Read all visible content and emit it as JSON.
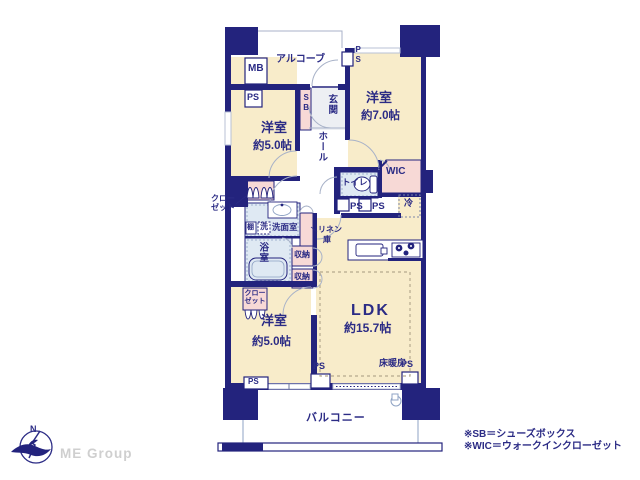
{
  "colors": {
    "wall_navy": "#23237d",
    "text_navy": "#2b2b85",
    "room_cream": "#f8ecca",
    "closet_pink": "#f7d9d6",
    "wet_blue": "#dfe9f3",
    "tile_gray": "#edeff3",
    "line_gray": "#a8b2c8",
    "heating_dash": "#b5a98e",
    "logo_gray": "#cfcfcf"
  },
  "rooms": {
    "bedroom_north": {
      "name": "洋室",
      "size": "約7.0帖"
    },
    "bedroom_west": {
      "name": "洋室",
      "size": "約5.0帖"
    },
    "bedroom_south": {
      "name": "洋室",
      "size": "約5.0帖"
    },
    "ldk": {
      "name": "LDK",
      "size": "約15.7帖",
      "floor_heating": "床暖房"
    },
    "balcony": "バルコニー",
    "alcove": "アルコーブ",
    "genkan": "玄関",
    "hall": "ホール",
    "washroom": "洗面室",
    "bath": "浴室",
    "toilet": "トイレ",
    "wic": "WIC"
  },
  "fixtures": {
    "mb": "MB",
    "ps": "PS",
    "sb": "SB",
    "fridge": "冷",
    "shelf": "棚",
    "washer": "洗",
    "storage": "収納",
    "linen_line1": "リネン",
    "linen_line2": "庫",
    "closet_line1": "クロー",
    "closet_line2": "ゼット"
  },
  "legend": {
    "note_sb": "※SB＝シューズボックス",
    "note_wic": "※WIC＝ウォークインクローゼット"
  },
  "logo": {
    "company": "ME Group",
    "compass_north": "N"
  }
}
